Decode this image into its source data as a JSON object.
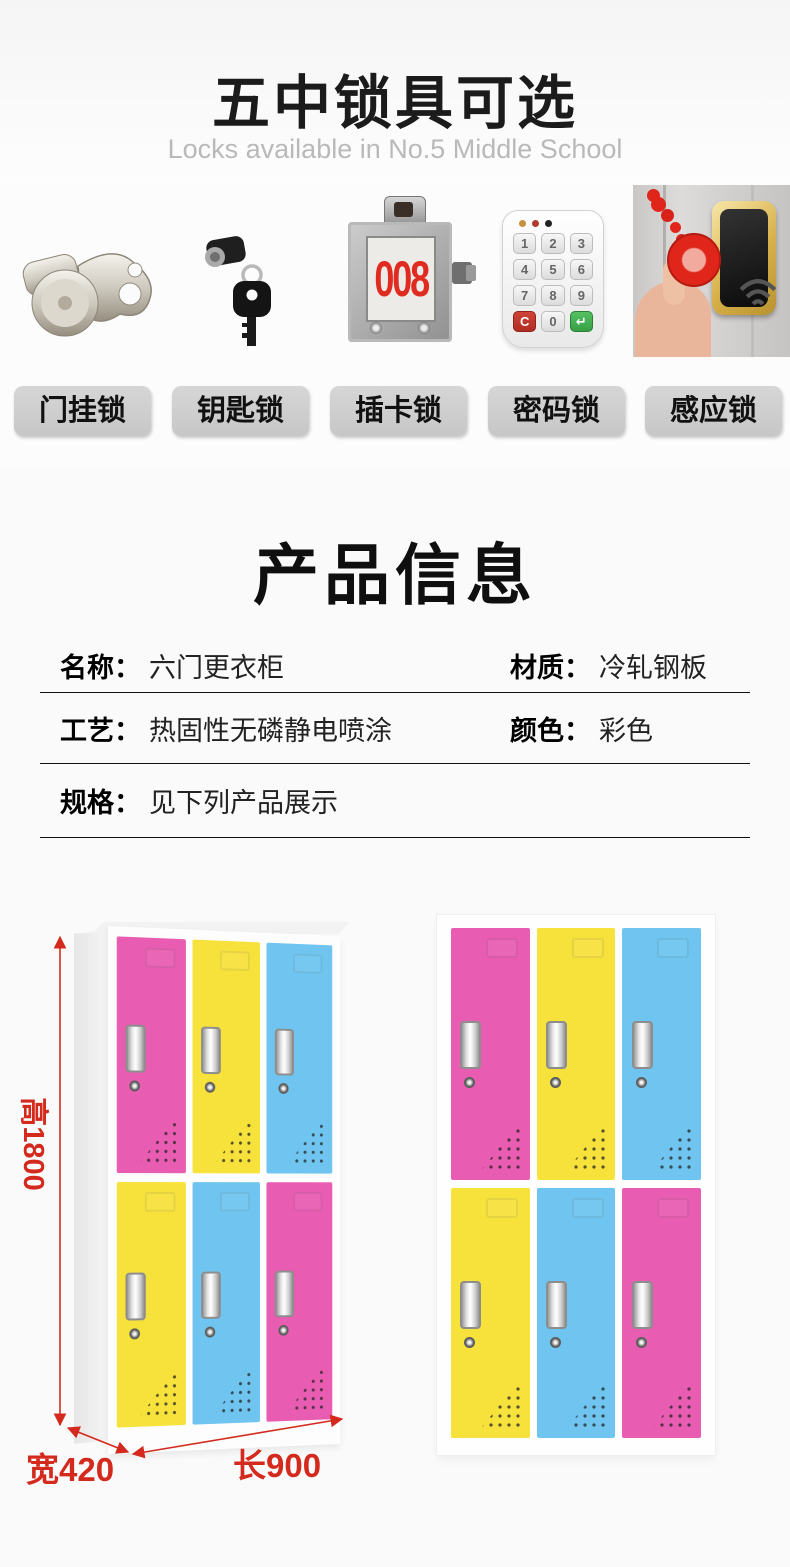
{
  "locks_section": {
    "title": "五中锁具可选",
    "subtitle": "Locks available in No.5 Middle School",
    "items": [
      {
        "label": "门挂锁",
        "icon": "hasp-lock-icon"
      },
      {
        "label": "钥匙锁",
        "icon": "key-lock-icon"
      },
      {
        "label": "插卡锁",
        "icon": "card-lock-icon"
      },
      {
        "label": "密码锁",
        "icon": "keypad-lock-icon"
      },
      {
        "label": "感应锁",
        "icon": "rfid-lock-icon"
      }
    ],
    "card_lock_number": "008",
    "keypad_keys": [
      "1",
      "2",
      "3",
      "4",
      "5",
      "6",
      "7",
      "8",
      "9",
      "C",
      "0",
      "↵"
    ]
  },
  "product_info": {
    "title": "产品信息",
    "rows": [
      {
        "cells": [
          {
            "label": "名称：",
            "value": "六门更衣柜"
          },
          {
            "label": "材质：",
            "value": "冷轧钢板"
          }
        ]
      },
      {
        "cells": [
          {
            "label": "工艺：",
            "value": "热固性无磷静电喷涂"
          },
          {
            "label": "颜色：",
            "value": "彩色"
          }
        ]
      },
      {
        "cells": [
          {
            "label": "规格：",
            "value": "见下列产品展示"
          }
        ]
      }
    ]
  },
  "dimensions": {
    "height": "高1800",
    "width": "宽420",
    "length": "长900"
  },
  "left_locker": {
    "top_doors": [
      "pink",
      "yellow",
      "blue"
    ],
    "bottom_doors": [
      "yellow",
      "blue",
      "pink"
    ]
  },
  "right_locker": {
    "top_doors": [
      "pink",
      "yellow",
      "blue"
    ],
    "bottom_doors": [
      "yellow",
      "blue",
      "pink"
    ]
  },
  "colors": {
    "door_pink": "#e85cb2",
    "door_yellow": "#f7e23c",
    "door_blue": "#6fc5f0",
    "dimension_red": "#d42a1e",
    "card_red": "#e02b20"
  }
}
